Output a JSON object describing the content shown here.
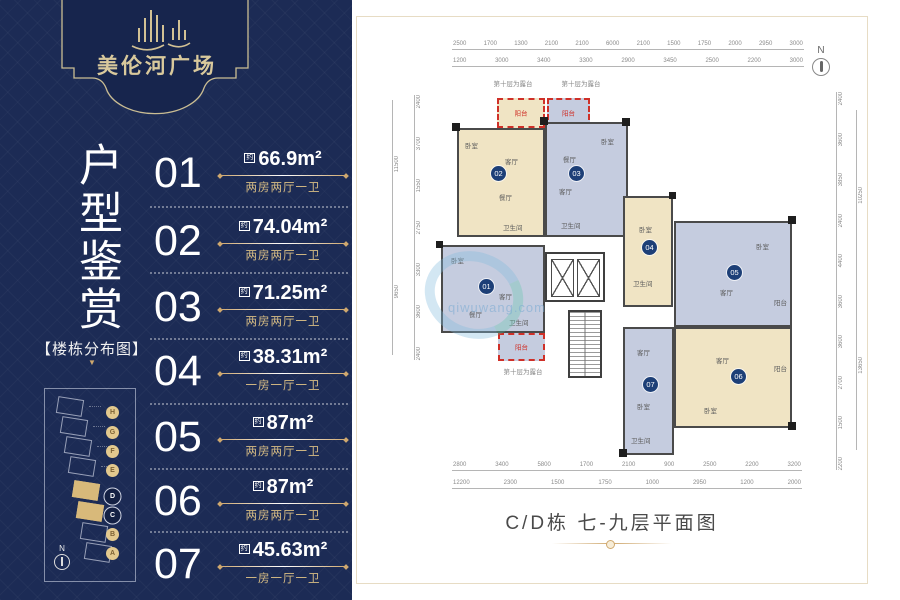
{
  "brand": {
    "name": "美伦河广场"
  },
  "left_panel": {
    "title": "户型鉴赏",
    "map_section_label": "【楼栋分布图】",
    "map_arrow": "▼",
    "units": [
      {
        "no": "01",
        "prefix": "约",
        "area": "66.9m²",
        "desc": "两房两厅一卫"
      },
      {
        "no": "02",
        "prefix": "约",
        "area": "74.04m²",
        "desc": "两房两厅一卫"
      },
      {
        "no": "03",
        "prefix": "约",
        "area": "71.25m²",
        "desc": "两房两厅一卫"
      },
      {
        "no": "04",
        "prefix": "约",
        "area": "38.31m²",
        "desc": "一房一厅一卫"
      },
      {
        "no": "05",
        "prefix": "约",
        "area": "87m²",
        "desc": "两房两厅一卫"
      },
      {
        "no": "06",
        "prefix": "约",
        "area": "87m²",
        "desc": "两房两厅一卫"
      },
      {
        "no": "07",
        "prefix": "约",
        "area": "45.63m²",
        "desc": "一房一厅一卫"
      }
    ],
    "map": {
      "buildings": [
        "H",
        "G",
        "F",
        "E",
        "D",
        "C",
        "B",
        "A"
      ],
      "highlighted": [
        "D",
        "C"
      ],
      "compass": "N"
    }
  },
  "plan": {
    "caption": "C/D栋 七-九层平面图",
    "compass": "N",
    "terrace_note": "第十层为露台",
    "balcony_label": "阳台",
    "watermark": "qiwuwang.com",
    "units": [
      {
        "no": "01",
        "rooms": [
          "卧室",
          "客厅",
          "餐厅",
          "卫生间"
        ]
      },
      {
        "no": "02",
        "rooms": [
          "卧室",
          "客厅",
          "餐厅",
          "卫生间"
        ]
      },
      {
        "no": "03",
        "rooms": [
          "餐厅",
          "客厅",
          "卧室",
          "卫生间"
        ]
      },
      {
        "no": "04",
        "rooms": [
          "卧室",
          "卫生间"
        ]
      },
      {
        "no": "05",
        "rooms": [
          "卧室",
          "客厅",
          "阳台"
        ]
      },
      {
        "no": "06",
        "rooms": [
          "客厅",
          "卧室",
          "阳台"
        ]
      },
      {
        "no": "07",
        "rooms": [
          "客厅",
          "卧室",
          "卫生间"
        ]
      }
    ],
    "dims": {
      "top1": [
        "2500",
        "1700",
        "1300",
        "2100",
        "2100",
        "6000",
        "2100",
        "1500",
        "1750",
        "2000",
        "2950",
        "3000"
      ],
      "top2": [
        "1200",
        "3000",
        "3400",
        "3300",
        "2900",
        "3450",
        "2500",
        "2200",
        "3000"
      ],
      "bottom1": [
        "2800",
        "3400",
        "5800",
        "1700",
        "2100",
        "900",
        "2500",
        "2200",
        "3200"
      ],
      "bottom2": [
        "12200",
        "2300",
        "1500",
        "1750",
        "1000",
        "2950",
        "1200",
        "2000"
      ],
      "left": [
        "2400",
        "3700",
        "1550",
        "2750",
        "3300",
        "3600",
        "2400"
      ],
      "left_totals": [
        "11500",
        "9650"
      ],
      "right": [
        "2400",
        "3600",
        "3850",
        "2400",
        "4400",
        "3600",
        "3600",
        "2700",
        "1500",
        "2200"
      ],
      "right_totals": [
        "10250",
        "13650"
      ]
    }
  },
  "colors": {
    "navy": "#1c2b55",
    "gold": "#cfa86e",
    "cream": "#d9c99c",
    "beige_unit": "#f0e4c4",
    "blue_unit": "#c5ccdf",
    "badge": "#1d3f77",
    "red_dash": "#cf3028",
    "wall": "#4a4a4a"
  }
}
